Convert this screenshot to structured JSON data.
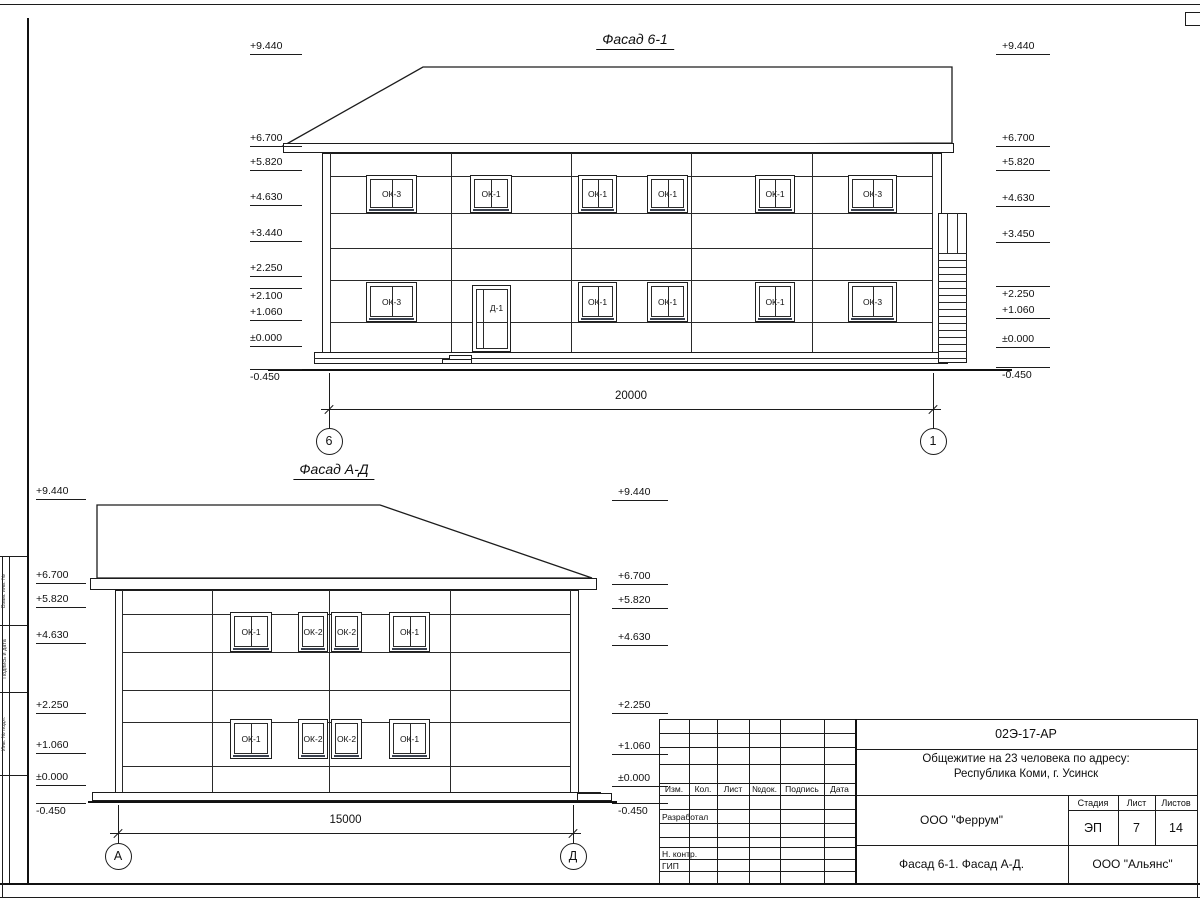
{
  "title_block": {
    "code": "02Э-17-АР",
    "object_line1": "Общежитие на 23 человека по адресу:",
    "object_line2": "Республика Коми, г. Усинск",
    "designer_org": "ООО \"Феррум\"",
    "sheet_caption": "Фасад 6-1. Фасад  А-Д.",
    "client_org": "ООО \"Альянс\"",
    "col_izm": "Изм.",
    "col_kol": "Кол.",
    "col_list": "Лист",
    "col_ndok": "№док.",
    "col_podpis": "Подпись",
    "col_data": "Дата",
    "row_razrabotal": "Разработал",
    "row_nkontr": "Н. контр.",
    "row_gip": "ГИП",
    "stage_label": "Стадия",
    "sheet_label": "Лист",
    "sheets_label": "Листов",
    "stage_value": "ЭП",
    "sheet_value": "7",
    "sheets_value": "14"
  },
  "margin_labels": {
    "vzam": "Взам. инв. №",
    "podp": "Подпись и дата",
    "inv": "Инв. № подл."
  },
  "line_color": "#1c1c1c",
  "sill_color": "#39404e",
  "facades": [
    {
      "id": "f1",
      "title": {
        "text": "Фасад 6-1",
        "cx": 635,
        "y": 31
      },
      "mark_geom": {
        "L": {
          "x1": 250,
          "x2": 302
        },
        "R": {
          "x1": 996,
          "x2": 1050
        }
      },
      "marks": [
        {
          "text": "+9.440",
          "side": "L",
          "shelf_y": 54,
          "type": "down"
        },
        {
          "text": "+6.700",
          "side": "L",
          "shelf_y": 146,
          "type": "down"
        },
        {
          "text": "+5.820",
          "side": "L",
          "shelf_y": 170,
          "type": "down"
        },
        {
          "text": "+4.630",
          "side": "L",
          "shelf_y": 205,
          "type": "down"
        },
        {
          "text": "+3.440",
          "side": "L",
          "shelf_y": 241,
          "type": "down"
        },
        {
          "text": "+2.250",
          "side": "L",
          "shelf_y": 276,
          "type": "down"
        },
        {
          "text": "+2.100",
          "side": "L",
          "shelf_y": 288,
          "type": "up"
        },
        {
          "text": "+1.060",
          "side": "L",
          "shelf_y": 320,
          "type": "down"
        },
        {
          "text": "±0.000",
          "side": "L",
          "shelf_y": 346,
          "type": "down"
        },
        {
          "text": "-0.450",
          "side": "L",
          "shelf_y": 369,
          "type": "up"
        },
        {
          "text": "+9.440",
          "side": "R",
          "shelf_y": 54,
          "type": "down"
        },
        {
          "text": "+6.700",
          "side": "R",
          "shelf_y": 146,
          "type": "down"
        },
        {
          "text": "+5.820",
          "side": "R",
          "shelf_y": 170,
          "type": "down"
        },
        {
          "text": "+4.630",
          "side": "R",
          "shelf_y": 206,
          "type": "down"
        },
        {
          "text": "+3.450",
          "side": "R",
          "shelf_y": 242,
          "type": "down"
        },
        {
          "text": "+2.250",
          "side": "R",
          "shelf_y": 286,
          "type": "up"
        },
        {
          "text": "+1.060",
          "side": "R",
          "shelf_y": 318,
          "type": "down"
        },
        {
          "text": "±0.000",
          "side": "R",
          "shelf_y": 347,
          "type": "down"
        },
        {
          "text": "-0.450",
          "side": "R",
          "shelf_y": 367,
          "type": "up"
        }
      ],
      "windows": [
        {
          "label": "ОК-3",
          "x": 366,
          "y": 175,
          "w": 51,
          "h": 38,
          "mullion": true
        },
        {
          "label": "ОК-1",
          "x": 470,
          "y": 175,
          "w": 42,
          "h": 38,
          "mullion": true
        },
        {
          "label": "ОК-1",
          "x": 578,
          "y": 175,
          "w": 39,
          "h": 38,
          "mullion": true
        },
        {
          "label": "ОК-1",
          "x": 647,
          "y": 175,
          "w": 41,
          "h": 38,
          "mullion": true
        },
        {
          "label": "ОК-1",
          "x": 755,
          "y": 175,
          "w": 40,
          "h": 38,
          "mullion": true
        },
        {
          "label": "ОК-3",
          "x": 848,
          "y": 175,
          "w": 49,
          "h": 38,
          "mullion": true
        },
        {
          "label": "ОК-3",
          "x": 366,
          "y": 282,
          "w": 51,
          "h": 40,
          "mullion": true
        },
        {
          "label": "ОК-1",
          "x": 578,
          "y": 282,
          "w": 39,
          "h": 40,
          "mullion": true
        },
        {
          "label": "ОК-1",
          "x": 647,
          "y": 282,
          "w": 41,
          "h": 40,
          "mullion": true
        },
        {
          "label": "ОК-1",
          "x": 755,
          "y": 282,
          "w": 40,
          "h": 40,
          "mullion": true
        },
        {
          "label": "ОК-3",
          "x": 848,
          "y": 282,
          "w": 49,
          "h": 40,
          "mullion": true
        }
      ],
      "door": {
        "label": "Д-1",
        "x": 472,
        "y": 285,
        "w": 39,
        "h": 67
      },
      "axes": [
        {
          "label": "6",
          "x": 329
        },
        {
          "label": "1",
          "x": 933
        }
      ],
      "axis_cy": 441,
      "dim": {
        "text": "20000",
        "x1": 329,
        "x2": 933,
        "y": 409,
        "ty": 390,
        "ext_y1": 373,
        "ext_y2": 428
      }
    },
    {
      "id": "f2",
      "title": {
        "text": "Фасад А-Д",
        "cx": 334,
        "y": 461
      },
      "mark_geom": {
        "L": {
          "x1": 36,
          "x2": 86
        },
        "R": {
          "x1": 612,
          "x2": 668
        }
      },
      "marks": [
        {
          "text": "+9.440",
          "side": "L",
          "shelf_y": 499,
          "type": "down"
        },
        {
          "text": "+6.700",
          "side": "L",
          "shelf_y": 583,
          "type": "down"
        },
        {
          "text": "+5.820",
          "side": "L",
          "shelf_y": 607,
          "type": "down"
        },
        {
          "text": "+4.630",
          "side": "L",
          "shelf_y": 643,
          "type": "down"
        },
        {
          "text": "+2.250",
          "side": "L",
          "shelf_y": 713,
          "type": "down"
        },
        {
          "text": "+1.060",
          "side": "L",
          "shelf_y": 753,
          "type": "down"
        },
        {
          "text": "±0.000",
          "side": "L",
          "shelf_y": 785,
          "type": "down"
        },
        {
          "text": "-0.450",
          "side": "L",
          "shelf_y": 803,
          "type": "up"
        },
        {
          "text": "+9.440",
          "side": "R",
          "shelf_y": 500,
          "type": "down"
        },
        {
          "text": "+6.700",
          "side": "R",
          "shelf_y": 584,
          "type": "down"
        },
        {
          "text": "+5.820",
          "side": "R",
          "shelf_y": 608,
          "type": "down"
        },
        {
          "text": "+4.630",
          "side": "R",
          "shelf_y": 645,
          "type": "down"
        },
        {
          "text": "+2.250",
          "side": "R",
          "shelf_y": 713,
          "type": "down"
        },
        {
          "text": "+1.060",
          "side": "R",
          "shelf_y": 754,
          "type": "down"
        },
        {
          "text": "±0.000",
          "side": "R",
          "shelf_y": 786,
          "type": "down"
        },
        {
          "text": "-0.450",
          "side": "R",
          "shelf_y": 803,
          "type": "up"
        }
      ],
      "windows": [
        {
          "label": "ОК-1",
          "x": 230,
          "y": 612,
          "w": 42,
          "h": 40,
          "mullion": true
        },
        {
          "label": "ОК-2",
          "x": 298,
          "y": 612,
          "w": 30,
          "h": 40,
          "mullion": false
        },
        {
          "label": "ОК-2",
          "x": 331,
          "y": 612,
          "w": 31,
          "h": 40,
          "mullion": false
        },
        {
          "label": "ОК-1",
          "x": 389,
          "y": 612,
          "w": 41,
          "h": 40,
          "mullion": true
        },
        {
          "label": "ОК-1",
          "x": 230,
          "y": 719,
          "w": 42,
          "h": 40,
          "mullion": true
        },
        {
          "label": "ОК-2",
          "x": 298,
          "y": 719,
          "w": 30,
          "h": 40,
          "mullion": false
        },
        {
          "label": "ОК-2",
          "x": 331,
          "y": 719,
          "w": 31,
          "h": 40,
          "mullion": false
        },
        {
          "label": "ОК-1",
          "x": 389,
          "y": 719,
          "w": 41,
          "h": 40,
          "mullion": true
        }
      ],
      "door": null,
      "axes": [
        {
          "label": "А",
          "x": 118
        },
        {
          "label": "Д",
          "x": 573
        }
      ],
      "axis_cy": 856,
      "dim": {
        "text": "15000",
        "x1": 118,
        "x2": 573,
        "y": 833,
        "ty": 814,
        "ext_y1": 805,
        "ext_y2": 843
      }
    }
  ]
}
